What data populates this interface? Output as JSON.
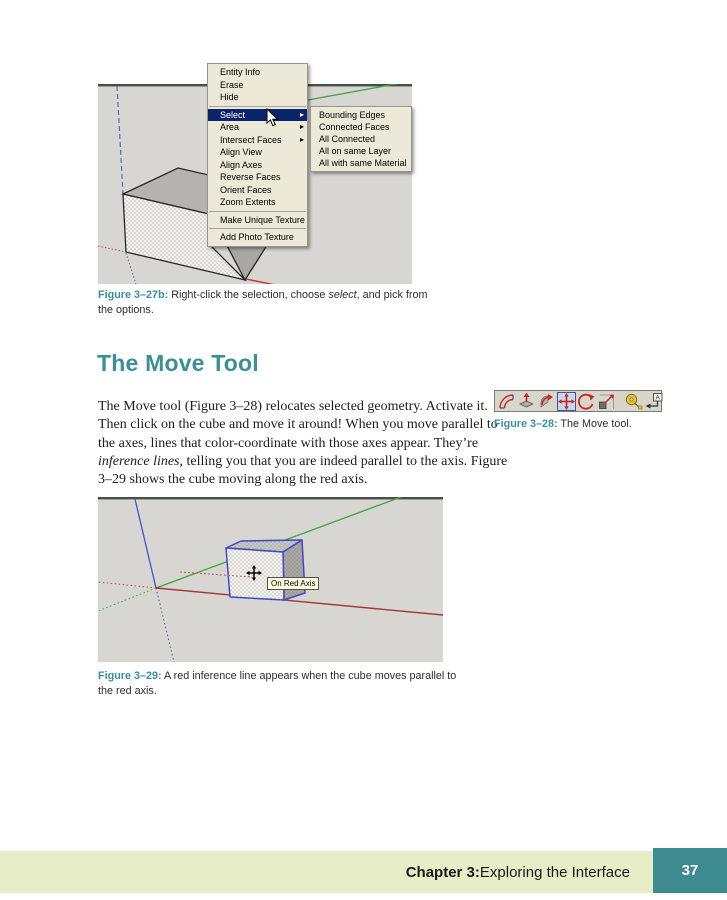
{
  "colors": {
    "accent_teal": "#3e8e96",
    "footer_bar_green": "#e7edc6",
    "page_number_teal": "#3d8b91",
    "menu_background": "#ece9d8",
    "menu_highlight": "#0a246a",
    "screenshot_background": "#d7d6d2",
    "axis_red": "#a33737",
    "axis_green": "#3fa23f",
    "axis_blue": "#4a52c4"
  },
  "figure27b": {
    "label": "Figure 3–27b:",
    "caption_pre": "Right-click the selection, choose ",
    "caption_italic": "select",
    "caption_post": ", and pick from the options."
  },
  "context_menu": {
    "items": [
      {
        "label": "Entity Info"
      },
      {
        "label": "Erase"
      },
      {
        "label": "Hide"
      },
      {
        "label": "Select",
        "highlighted": true,
        "has_submenu": true
      },
      {
        "label": "Area",
        "has_submenu": true
      },
      {
        "label": "Intersect Faces",
        "has_submenu": true
      },
      {
        "label": "Align View"
      },
      {
        "label": "Align Axes"
      },
      {
        "label": "Reverse Faces"
      },
      {
        "label": "Orient Faces"
      },
      {
        "label": "Zoom Extents"
      },
      {
        "label": "Make Unique Texture"
      },
      {
        "label": "Add Photo Texture"
      }
    ]
  },
  "select_submenu": {
    "items": [
      {
        "label": "Bounding Edges"
      },
      {
        "label": "Connected Faces"
      },
      {
        "label": "All Connected"
      },
      {
        "label": "All on same Layer"
      },
      {
        "label": "All with same Material"
      }
    ]
  },
  "section": {
    "title": "The Move Tool"
  },
  "paragraph": {
    "pre": "The Move tool (Figure 3–28) relocates selected geometry. Activate it. Then click on the cube and move it around! When you move parallel to the axes, lines that color-coordinate with those axes appear. They’re ",
    "italic": "inference lines",
    "post": ", telling you that you are indeed parallel to the axis. Figure 3–29 shows the cube moving along the red axis."
  },
  "figure28": {
    "label": "Figure 3–28:",
    "caption": " The Move tool.",
    "toolbar_icons": [
      "offset",
      "push-pull",
      "follow-me",
      "move",
      "rotate",
      "scale",
      "tape-measure",
      "text"
    ],
    "selected_tool": "move"
  },
  "figure29": {
    "label": "Figure 3–29:",
    "caption": " A red inference line appears when the cube moves parallel to the red axis.",
    "tooltip": "On Red Axis"
  },
  "footer": {
    "chapter_label": "Chapter 3:",
    "chapter_rest": " Exploring the Interface",
    "page_number": "37"
  }
}
